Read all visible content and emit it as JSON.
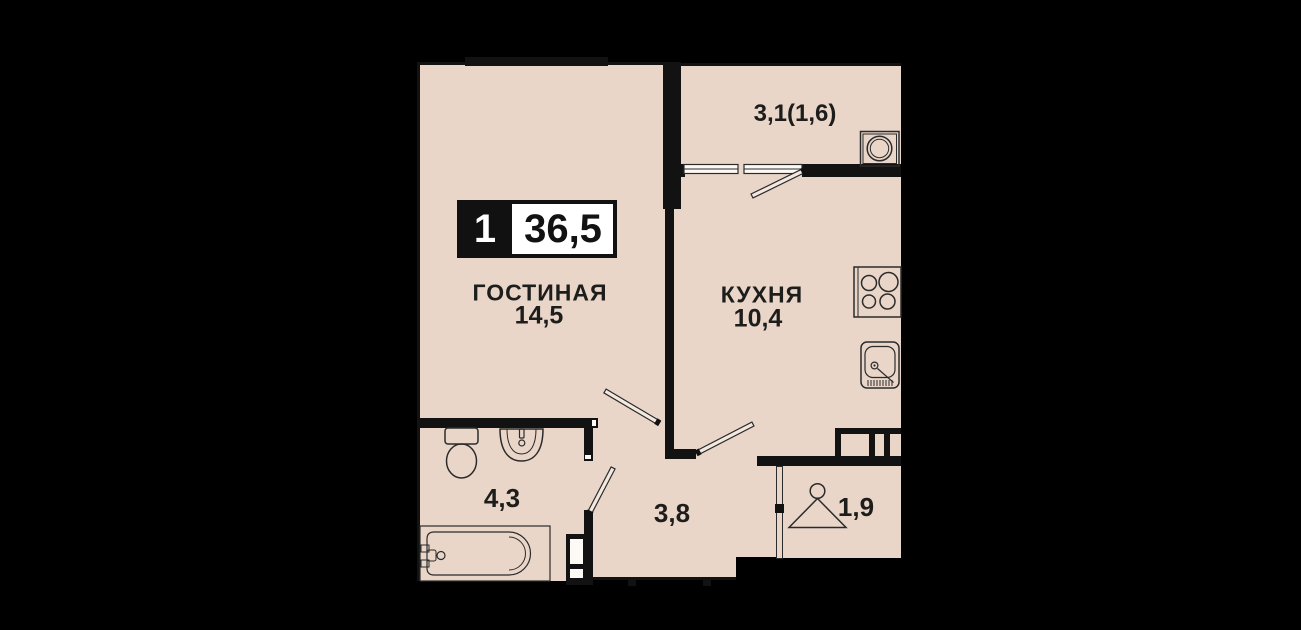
{
  "title": "Apartment floor plan 1-room 36,5 m2",
  "badge": {
    "rooms_count": "1",
    "total_area": "36,5"
  },
  "rooms": {
    "living": {
      "name": "ГОСТИНАЯ",
      "area": "14,5"
    },
    "kitchen": {
      "name": "КУХНЯ",
      "area": "10,4"
    },
    "balcony": {
      "area": "3,1(1,6)"
    },
    "bathroom": {
      "area": "4,3"
    },
    "hallway": {
      "area": "3,8"
    },
    "wardrobe": {
      "area": "1,9"
    }
  },
  "fixtures": [
    "washing-machine",
    "stove",
    "kitchen-sink",
    "wash-basin",
    "toilet",
    "bathtub",
    "hanger",
    "window",
    "door-swing",
    "vent-shaft"
  ],
  "colors": {
    "background": "#000000",
    "floor": "#e9d6c9",
    "wall": "#121212",
    "outline": "#2b2b2b",
    "text": "#1d1d1b",
    "badge_bg": "#111111",
    "badge_panel": "#ffffff"
  }
}
